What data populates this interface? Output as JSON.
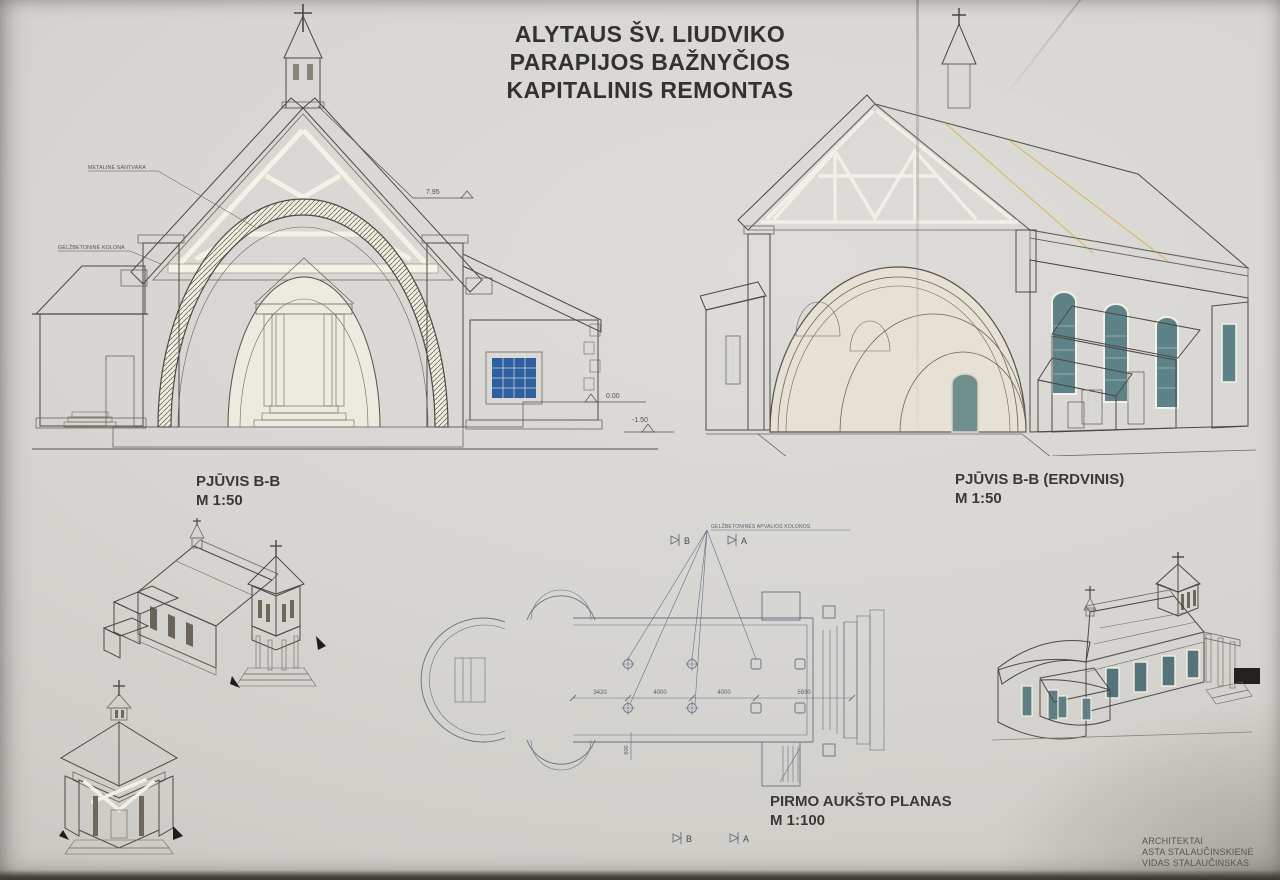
{
  "title": {
    "lines": [
      "ALYTAUS ŠV. LIUDVIKO",
      "PARAPIJOS BAŽNYČIOS",
      "KAPITALINIS REMONTAS"
    ]
  },
  "drawings": {
    "section_left": {
      "label": "PJŪVIS B-B",
      "scale": "M 1:50",
      "annotations": {
        "truss": "METALINĖ SANTVARA",
        "column": "GELŽBETONINĖ KOLONA",
        "level_ridge": "7.95",
        "level_zero": "0.00",
        "level_below": "-1.50"
      }
    },
    "section_3d": {
      "label": "PJŪVIS B-B (ERDVINIS)",
      "scale": "M 1:50"
    },
    "floor_plan": {
      "label": "PIRMO AUKŠTO PLANAS",
      "scale": "M 1:100",
      "annotation_columns": "GELŽBETONINĖS APVALIOS KOLONOS",
      "dimensions": [
        "3420",
        "4000",
        "4000",
        "5930"
      ],
      "dimension_vertical": "600",
      "section_marker_b": "B",
      "section_marker_a": "A"
    }
  },
  "credits": {
    "lines": [
      "ARCHITEKTAI",
      "ASTA STALAUČINSKIENĖ",
      "VIDAS STALAUČINSKAS"
    ]
  },
  "colors": {
    "paper": "#d8d6d2",
    "ink": "#4c4944",
    "roof_yellow": "#e7c45c",
    "roof_light": "#e9cf74",
    "terracotta": "#d49878",
    "wall": "#e9e6dc",
    "stone": "#ddd6c5",
    "window_blue": "#2e5f9e",
    "glass_teal": "#5d8288",
    "plan_line": "#647082"
  }
}
